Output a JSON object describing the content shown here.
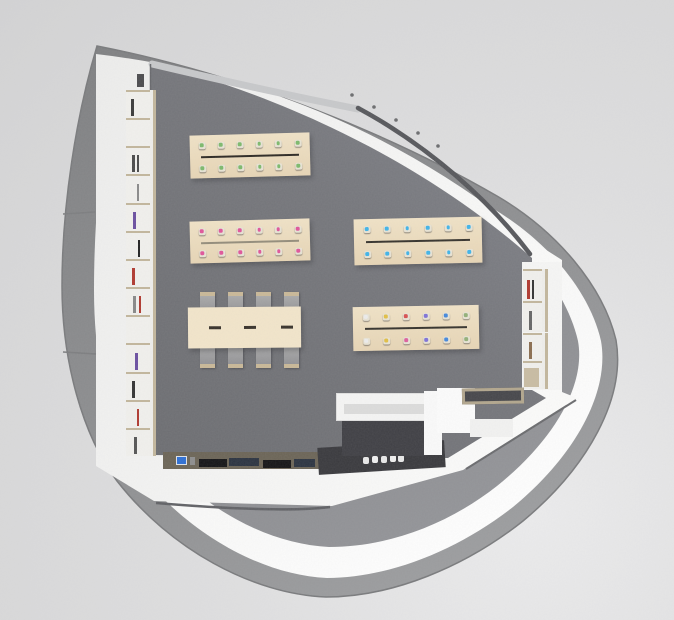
{
  "scene": {
    "description": "top-down 3D architectural render of an organically shaped (pick-shaped) studio room with worktables, a conference table, wall shelving, a kitchen counter and a reception desk",
    "palette": {
      "background": "#dedede",
      "outer_shell": "#8e8f91",
      "wall_rim_white": "#f6f6f5",
      "wall_cavity": "#8a8b8e",
      "room_wall": "#f4f4f3",
      "floor": "#76777b",
      "table_top": "#ebdabd",
      "conference_top": "#f2e5ca",
      "chair_gray": "#9d9d9d",
      "chair_trim": "#c9b897",
      "glazing_dark": "#56575b",
      "counter_wood": "#6b6456",
      "island_dark": "#39393d",
      "shelf_frame": "#c2b69c",
      "dot_green": "#7cb96b",
      "dot_pink": "#e0559a",
      "dot_cyan": "#3fb3e8"
    },
    "furniture": {
      "tables": [
        {
          "name": "worktable-green",
          "x": 190,
          "y": 134,
          "w": 120,
          "h": 43,
          "rot": -1.5,
          "line": {
            "x1": 11,
            "x2": 109,
            "y": 21,
            "t": 2,
            "color": "#2c2822"
          },
          "row_y": [
            10,
            33
          ],
          "dot_margin": 12,
          "dot_rows": [
            [
              "#7cb96b",
              "#7cb96b",
              "#7cb96b",
              "#7cb96b",
              "#7cb96b",
              "#7cb96b"
            ],
            [
              "#7cb96b",
              "#7cb96b",
              "#7cb96b",
              "#7cb96b",
              "#7cb96b",
              "#7cb96b"
            ]
          ]
        },
        {
          "name": "worktable-pink",
          "x": 190,
          "y": 220,
          "w": 120,
          "h": 42,
          "rot": -1.5,
          "line": {
            "x1": 11,
            "x2": 109,
            "y": 21,
            "t": 2,
            "color": "#938c7a"
          },
          "row_y": [
            10,
            32
          ],
          "dot_margin": 12,
          "dot_rows": [
            [
              "#e0559a",
              "#e0559a",
              "#e0559a",
              "#e0559a",
              "#e0559a",
              "#e0559a"
            ],
            [
              "#e0559a",
              "#e0559a",
              "#e0559a",
              "#e0559a",
              "#e0559a",
              "#e0559a"
            ]
          ]
        },
        {
          "name": "worktable-cyan",
          "x": 354,
          "y": 218,
          "w": 128,
          "h": 46,
          "rot": -1.2,
          "line": {
            "x1": 12,
            "x2": 116,
            "y": 22,
            "t": 2,
            "color": "#35322c"
          },
          "row_y": [
            10,
            35
          ],
          "dot_margin": 13,
          "dot_rows": [
            [
              "#3fb3e8",
              "#3fb3e8",
              "#3fb3e8",
              "#3fb3e8",
              "#3fb3e8",
              "#3fb3e8"
            ],
            [
              "#3fb3e8",
              "#3fb3e8",
              "#3fb3e8",
              "#3fb3e8",
              "#3fb3e8",
              "#3fb3e8"
            ]
          ]
        },
        {
          "name": "worktable-multicolor",
          "x": 353,
          "y": 306,
          "w": 126,
          "h": 44,
          "rot": -1,
          "line": {
            "x1": 12,
            "x2": 114,
            "y": 21,
            "t": 2,
            "color": "#35322c"
          },
          "row_y": [
            10,
            34
          ],
          "dot_margin": 13,
          "dot_rows": [
            [
              "#ececec",
              "#e2bf45",
              "#d85050",
              "#7e72d8",
              "#4488dc",
              "#93b078"
            ],
            [
              "#ececec",
              "#e2bf45",
              "#de5f9d",
              "#7e72d8",
              "#4488dc",
              "#93b078"
            ]
          ]
        },
        {
          "name": "conference-table",
          "x": 188,
          "y": 307,
          "w": 113,
          "h": 41,
          "rot": -0.5,
          "top": "#f2e5ca",
          "dashes": {
            "y": 19,
            "t": 2.5,
            "w": 12,
            "color": "#37312a",
            "xs": [
              21,
              56,
              93
            ]
          }
        }
      ],
      "chairs": {
        "color": "#9d9d9d",
        "trim": "#c9b897",
        "w": 15,
        "h": 17,
        "top": {
          "y": 292,
          "xs": [
            200,
            228,
            256,
            284
          ]
        },
        "bottom": {
          "y": 347,
          "xs": [
            200,
            228,
            256,
            284
          ]
        }
      },
      "left_shelf": {
        "name": "left-wall-shelving",
        "x": 126,
        "y": 90,
        "w": 27,
        "h": 366,
        "frame": "#c2b69c",
        "cells": [
          {
            "items": [
              {
                "c": "#3a3a3a",
                "p": 0.25
              }
            ]
          },
          {
            "items": []
          },
          {
            "items": [
              {
                "c": "#4a4a4a",
                "p": 0.3
              },
              {
                "c": "#4a4a4a",
                "p": 0.5
              }
            ]
          },
          {
            "items": [
              {
                "c": "#8a8a8a",
                "p": 0.5
              }
            ]
          },
          {
            "items": [
              {
                "c": "#6b4fa0",
                "p": 0.35
              }
            ]
          },
          {
            "items": [
              {
                "c": "#222222",
                "p": 0.55
              }
            ]
          },
          {
            "items": [
              {
                "c": "#b0392f",
                "p": 0.3
              }
            ]
          },
          {
            "items": [
              {
                "c": "#888888",
                "p": 0.35
              },
              {
                "c": "#b0392f",
                "p": 0.6
              }
            ]
          },
          {
            "items": []
          },
          {
            "items": [
              {
                "c": "#6b4fa0",
                "p": 0.45
              }
            ]
          },
          {
            "items": [
              {
                "c": "#333333",
                "p": 0.3
              }
            ]
          },
          {
            "items": [
              {
                "c": "#b0392f",
                "p": 0.5
              }
            ]
          },
          {
            "items": [
              {
                "c": "#555555",
                "p": 0.4
              }
            ]
          }
        ]
      },
      "right_shelf": {
        "name": "alcove-shelving",
        "units": [
          {
            "x": 523,
            "y": 269,
            "w": 22,
            "h": 63,
            "cells": [
              {
                "items": [
                  {
                    "c": "#b0392f",
                    "p": 0.25
                  },
                  {
                    "c": "#333333",
                    "p": 0.55
                  }
                ]
              },
              {
                "items": [
                  {
                    "c": "#666666",
                    "p": 0.4
                  }
                ]
              }
            ]
          },
          {
            "x": 523,
            "y": 333,
            "w": 22,
            "h": 56,
            "cells": [
              {
                "items": [
                  {
                    "c": "#8a6d4f",
                    "p": 0.4
                  }
                ]
              },
              {
                "items": [
                  {
                    "c": "#444444",
                    "p": 0.6
                  }
                ]
              }
            ]
          }
        ]
      },
      "props": [
        {
          "name": "wall-vent-slot",
          "x": 137,
          "y": 74,
          "w": 7,
          "h": 13,
          "color": "#4b4b4e"
        },
        {
          "name": "kitchen-counter-top",
          "x": 163,
          "y": 452,
          "w": 156,
          "h": 17,
          "color": "#6b6456"
        },
        {
          "name": "appliance-screen",
          "x": 176,
          "y": 456,
          "w": 11,
          "h": 9,
          "color": "#2e6fd4",
          "border": "1px solid #dfe3e8"
        },
        {
          "name": "appliance-knob",
          "x": 190,
          "y": 457,
          "w": 5,
          "h": 8,
          "color": "#8d8d8d"
        },
        {
          "name": "cooktop-left",
          "x": 199,
          "y": 459,
          "w": 28,
          "h": 8,
          "color": "#141416"
        },
        {
          "name": "sink-left",
          "x": 229,
          "y": 458,
          "w": 30,
          "h": 8,
          "color": "#2b3340"
        },
        {
          "name": "cooktop-right",
          "x": 263,
          "y": 460,
          "w": 28,
          "h": 8,
          "color": "#141416"
        },
        {
          "name": "sink-right",
          "x": 294,
          "y": 459,
          "w": 21,
          "h": 8,
          "color": "#2b3340"
        },
        {
          "name": "dark-counter-island",
          "x": 318,
          "y": 444,
          "w": 127,
          "h": 27,
          "color": "#39393d",
          "rot": -3.5
        },
        {
          "name": "island-item",
          "x": 363,
          "y": 457,
          "w": 6,
          "h": 7,
          "color": "#e9e9e9",
          "rx": 2
        },
        {
          "name": "island-item",
          "x": 372,
          "y": 456,
          "w": 6,
          "h": 7,
          "color": "#f0f0f0",
          "rx": 2
        },
        {
          "name": "island-item",
          "x": 381,
          "y": 456,
          "w": 6,
          "h": 7,
          "color": "#e9e9e9",
          "rx": 2
        },
        {
          "name": "island-item",
          "x": 390,
          "y": 455,
          "w": 6,
          "h": 7,
          "color": "#f0f0f0",
          "rx": 2
        },
        {
          "name": "island-item",
          "x": 398,
          "y": 455,
          "w": 6,
          "h": 7,
          "color": "#e9e9e9",
          "rx": 2
        },
        {
          "name": "desk-inner-dark",
          "x": 342,
          "y": 416,
          "w": 84,
          "h": 40,
          "color": "#3f3f44"
        },
        {
          "name": "reception-desk-bar",
          "x": 336,
          "y": 393,
          "w": 102,
          "h": 28,
          "color": "#f5f5f4",
          "border": "1px solid #e0e0df"
        },
        {
          "name": "desk-bar-shadow",
          "x": 344,
          "y": 404,
          "w": 88,
          "h": 10,
          "color": "#dcdcdb"
        },
        {
          "name": "desk-return-panel",
          "x": 424,
          "y": 391,
          "w": 18,
          "h": 64,
          "color": "#fafafa"
        },
        {
          "name": "desk-block",
          "x": 437,
          "y": 388,
          "w": 38,
          "h": 45,
          "color": "#fcfcfc"
        },
        {
          "name": "desk-step",
          "x": 470,
          "y": 419,
          "w": 43,
          "h": 18,
          "color": "#f2f2f1"
        },
        {
          "name": "entrance-doormat",
          "x": 462,
          "y": 388,
          "w": 62,
          "h": 16,
          "color": "#46464a",
          "border": "3px solid #b2a68d",
          "rot": -1
        },
        {
          "name": "alcove-wood-panel",
          "x": 524,
          "y": 368,
          "w": 15,
          "h": 19,
          "color": "#c8bca2"
        }
      ]
    }
  }
}
